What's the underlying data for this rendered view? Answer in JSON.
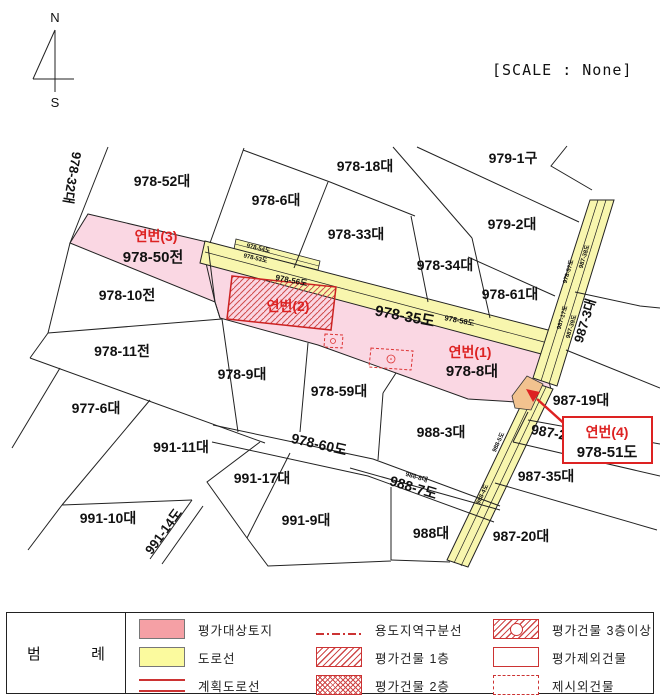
{
  "scale_text": "[SCALE : None]",
  "compass": {
    "north": "N",
    "south": "S"
  },
  "map": {
    "labels": [
      {
        "id": "compass-n",
        "t": "N",
        "x": 55,
        "y": 22,
        "s": 13,
        "w": 400
      },
      {
        "id": "compass-s",
        "t": "S",
        "x": 55,
        "y": 107,
        "s": 13,
        "w": 400
      },
      {
        "id": "978-32",
        "t": "978-32대",
        "x": 68,
        "y": 177,
        "s": 13,
        "r": 100
      },
      {
        "id": "978-52",
        "t": "978-52대",
        "x": 162,
        "y": 186,
        "s": 14
      },
      {
        "id": "978-18",
        "t": "978-18대",
        "x": 365,
        "y": 171,
        "s": 14
      },
      {
        "id": "979-1",
        "t": "979-1구",
        "x": 513,
        "y": 163,
        "s": 14
      },
      {
        "id": "978-6",
        "t": "978-6대",
        "x": 276,
        "y": 205,
        "s": 14
      },
      {
        "id": "978-33",
        "t": "978-33대",
        "x": 356,
        "y": 239,
        "s": 14
      },
      {
        "id": "979-2",
        "t": "979-2대",
        "x": 512,
        "y": 229,
        "s": 14
      },
      {
        "id": "978-34",
        "t": "978-34대",
        "x": 445,
        "y": 270,
        "s": 14
      },
      {
        "id": "978-61",
        "t": "978-61대",
        "x": 510,
        "y": 299,
        "s": 14
      },
      {
        "id": "yeonbeon-3",
        "t": "연번(3)",
        "x": 156,
        "y": 241,
        "s": 14,
        "c": "red"
      },
      {
        "id": "978-50",
        "t": "978-50전",
        "x": 153,
        "y": 262,
        "s": 15
      },
      {
        "id": "978-10",
        "t": "978-10전",
        "x": 127,
        "y": 300,
        "s": 14
      },
      {
        "id": "987-3",
        "t": "987-3대",
        "x": 589,
        "y": 322,
        "s": 13,
        "r": -73
      },
      {
        "id": "yeonbeon-2",
        "t": "연번(2)",
        "x": 288,
        "y": 311,
        "s": 14,
        "c": "red"
      },
      {
        "id": "978-35ro",
        "t": "978-35도",
        "x": 404,
        "y": 321,
        "s": 15,
        "r": 11
      },
      {
        "id": "978-58ro",
        "t": "978-58도",
        "x": 459,
        "y": 323,
        "s": 7.5,
        "r": 11
      },
      {
        "id": "978-56ro",
        "t": "978-56도",
        "x": 291,
        "y": 283,
        "s": 8,
        "r": 11
      },
      {
        "id": "978-54ro",
        "t": "978-54도",
        "x": 258,
        "y": 250,
        "s": 6,
        "r": 13
      },
      {
        "id": "978-53ro",
        "t": "978-53도",
        "x": 255,
        "y": 260,
        "s": 6,
        "r": 13
      },
      {
        "id": "978-57ro",
        "t": "978-57도",
        "x": 570,
        "y": 272,
        "s": 6,
        "r": -73
      },
      {
        "id": "987-38ro",
        "t": "987-38도",
        "x": 586,
        "y": 257,
        "s": 6,
        "r": -73
      },
      {
        "id": "987-17ro",
        "t": "987-17도",
        "x": 564,
        "y": 318,
        "s": 6,
        "r": -73
      },
      {
        "id": "987-39ro",
        "t": "987-39도",
        "x": 573,
        "y": 327,
        "s": 6,
        "r": -73
      },
      {
        "id": "978-11",
        "t": "978-11전",
        "x": 122,
        "y": 356,
        "s": 14
      },
      {
        "id": "yeonbeon-1",
        "t": "연번(1)",
        "x": 470,
        "y": 357,
        "s": 14,
        "c": "red"
      },
      {
        "id": "978-8",
        "t": "978-8대",
        "x": 472,
        "y": 376,
        "s": 15
      },
      {
        "id": "978-9",
        "t": "978-9대",
        "x": 242,
        "y": 379,
        "s": 14
      },
      {
        "id": "977-6",
        "t": "977-6대",
        "x": 96,
        "y": 413,
        "s": 14
      },
      {
        "id": "978-59",
        "t": "978-59대",
        "x": 339,
        "y": 396,
        "s": 14
      },
      {
        "id": "987-19",
        "t": "987-19대",
        "x": 581,
        "y": 405,
        "s": 14
      },
      {
        "id": "991-11",
        "t": "991-11대",
        "x": 181,
        "y": 452,
        "s": 14
      },
      {
        "id": "988-3",
        "t": "988-3대",
        "x": 441,
        "y": 437,
        "s": 14
      },
      {
        "id": "987-2",
        "t": "987-2",
        "x": 548,
        "y": 437,
        "s": 14,
        "r": 10
      },
      {
        "id": "978-60ro",
        "t": "978-60도",
        "x": 318,
        "y": 449,
        "s": 14,
        "r": 13
      },
      {
        "id": "988-8",
        "t": "988-8대",
        "x": 416,
        "y": 479,
        "s": 6.5,
        "r": 17
      },
      {
        "id": "988-7ro",
        "t": "988-7도",
        "x": 412,
        "y": 492,
        "s": 14,
        "r": 17
      },
      {
        "id": "988-5ro",
        "t": "988-5도",
        "x": 500,
        "y": 443,
        "s": 6,
        "r": -65
      },
      {
        "id": "988-4ro",
        "t": "988-4도",
        "x": 484,
        "y": 495,
        "s": 6,
        "r": -65
      },
      {
        "id": "991-17",
        "t": "991-17대",
        "x": 262,
        "y": 483,
        "s": 14
      },
      {
        "id": "987-35",
        "t": "987-35대",
        "x": 546,
        "y": 481,
        "s": 14
      },
      {
        "id": "991-10",
        "t": "991-10대",
        "x": 108,
        "y": 523,
        "s": 14
      },
      {
        "id": "991-14ro",
        "t": "991-14도",
        "x": 167,
        "y": 534,
        "s": 13,
        "r": -54
      },
      {
        "id": "991-9",
        "t": "991-9대",
        "x": 306,
        "y": 525,
        "s": 14
      },
      {
        "id": "988",
        "t": "988대",
        "x": 431,
        "y": 538,
        "s": 14
      },
      {
        "id": "987-20",
        "t": "987-20대",
        "x": 521,
        "y": 541,
        "s": 14
      }
    ],
    "overlay_labels": [
      {
        "id": "yeonbeon-4",
        "t": "연번(4)",
        "x": 607,
        "y": 437,
        "s": 14,
        "c": "red"
      },
      {
        "id": "978-51ro",
        "t": "978-51도",
        "x": 607,
        "y": 457,
        "s": 15
      }
    ]
  },
  "legend": {
    "title": "범  례",
    "items": [
      {
        "label": "평가대상토지",
        "swatch": "pink-box"
      },
      {
        "label": "도로선",
        "swatch": "yellow-box"
      },
      {
        "label": "계획도로선",
        "swatch": "red-lines"
      },
      {
        "label": "용도지역구분선",
        "swatch": "dashdot-line"
      },
      {
        "label": "평가건물 1층",
        "swatch": "diag-hatch"
      },
      {
        "label": "평가건물 2층",
        "swatch": "cross-hatch"
      },
      {
        "label": "평가건물 3층이상",
        "swatch": "hatch-circle"
      },
      {
        "label": "평가제외건물",
        "swatch": "plain-box"
      },
      {
        "label": "제시외건물",
        "swatch": "dashed-box"
      }
    ]
  },
  "colors": {
    "parcel_pink": "#FAD7E3",
    "road_yellow": "#F8F6AE",
    "junction_orange": "#F2C28F",
    "annotation_red": "#DD2222",
    "legend_red": "#CC3333",
    "line_black": "#222222"
  }
}
